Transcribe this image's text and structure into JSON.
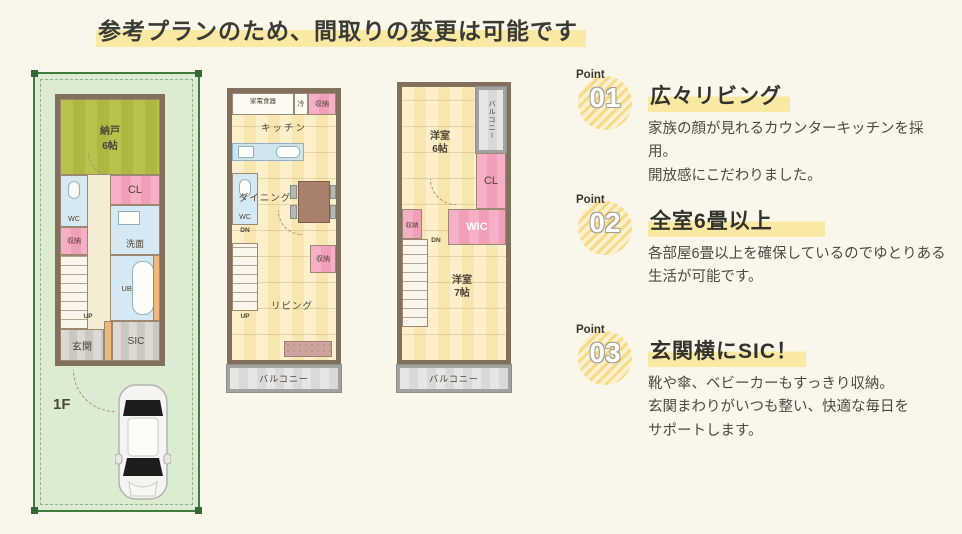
{
  "header": {
    "title": "参考プランのため、間取りの変更は可能です"
  },
  "plans": {
    "f1": {
      "floor_label": "1F",
      "nando": "納戸\n6帖",
      "cl": "CL",
      "wc": "WC",
      "shuno": "収納",
      "senmen": "洗面",
      "bath": "UB1616",
      "up": "UP",
      "genkan": "玄関",
      "sic": "SIC"
    },
    "f2": {
      "kaden": "家電食器",
      "rei": "冷",
      "shuno_top": "収納",
      "kitchen": "キッチン",
      "wc": "WC",
      "dn": "DN",
      "dining": "ダイニング",
      "up": "UP",
      "shuno_mid": "収納",
      "living": "リビング",
      "balcony": "バルコニー"
    },
    "f3": {
      "balcony_top": "バルコニー",
      "yoshitsu6": "洋室\n6帖",
      "cl": "CL",
      "shuno": "収納",
      "wic": "WIC",
      "dn": "DN",
      "yoshitsu7": "洋室\n7帖",
      "balcony_bottom": "バルコニー"
    }
  },
  "points": [
    {
      "badge_label": "Point",
      "number": "01",
      "title": "広々リビング",
      "body": "家族の顔が見れるカウンターキッチンを採用。\n開放感にこだわりました。"
    },
    {
      "badge_label": "Point",
      "number": "02",
      "title": "全室6畳以上",
      "body": "各部屋6畳以上を確保しているのでゆとりある\n生活が可能です。"
    },
    {
      "badge_label": "Point",
      "number": "03",
      "title": "玄関横にSIC！",
      "body": "靴や傘、ベビーカーもすっきり収納。\n玄関まわりがいつも整い、快適な毎日を\nサポートします。"
    }
  ],
  "colors": {
    "background": "#faf6e9",
    "highlight_yellow": "#fae9a3",
    "plot_green": "#dcecd2",
    "plot_border": "#3f7d3f",
    "tatami_green": "#b9c24a",
    "room_yellow": "#fcefc9",
    "closet_pink": "#f4a6bd",
    "wet_blue": "#d6e9f2",
    "wall_brown": "#83705c",
    "balcony_gray": "#e6e6e4",
    "badge_stripe_yellow": "#f6da86"
  }
}
